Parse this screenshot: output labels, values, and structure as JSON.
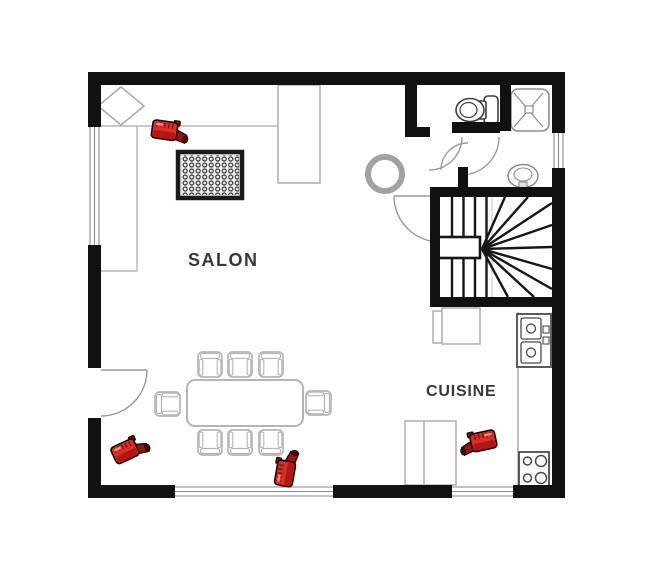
{
  "rooms": {
    "salon": {
      "label": "SALON"
    },
    "cuisine": {
      "label": "CUISINE"
    }
  },
  "colors": {
    "wall": "#111111",
    "furniture_outline": "#b5b5b5",
    "fixture_outline": "#555555",
    "camera_red": "#d93025"
  },
  "cameras": [
    {
      "id": "camera-1",
      "x": 150,
      "y": 115,
      "rotate": 8,
      "flip": false
    },
    {
      "id": "camera-2",
      "x": 110,
      "y": 433,
      "rotate": -25,
      "flip": false
    },
    {
      "id": "camera-3",
      "x": 266,
      "y": 452,
      "rotate": -80,
      "flip": false
    },
    {
      "id": "camera-4",
      "x": 498,
      "y": 426,
      "rotate": 12,
      "flip": true
    }
  ]
}
